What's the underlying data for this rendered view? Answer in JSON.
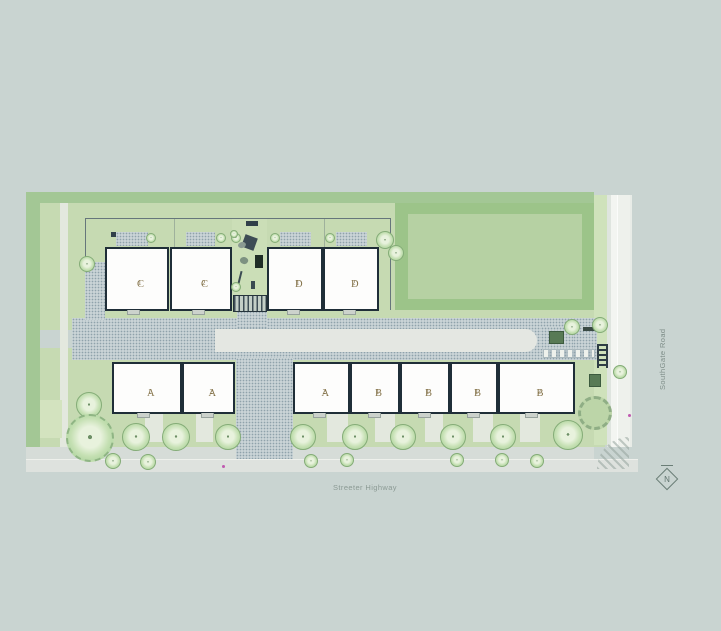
{
  "streets": {
    "right": "SouthGate Road",
    "bottom": "Streeter Highway"
  },
  "north_label": "N",
  "colors": {
    "background": "#c9d4d1",
    "planting_band": "#a3c795",
    "yard_green": "#c6dab2",
    "lawn": "#b6d1a3",
    "building_outline": "#1f2e38",
    "building_fill": "#fdfdfc",
    "unit_label": "#85744b",
    "road": "#eef1ed"
  },
  "site": {
    "buildings": [
      {
        "id": "C1",
        "letter": "C",
        "num": "1",
        "x": 105,
        "y": 247,
        "w": 64,
        "h": 64
      },
      {
        "id": "C2",
        "letter": "C",
        "num": "2",
        "x": 170,
        "y": 247,
        "w": 62,
        "h": 64
      },
      {
        "id": "D1",
        "letter": "D",
        "num": "1",
        "x": 267,
        "y": 247,
        "w": 56,
        "h": 64
      },
      {
        "id": "D2",
        "letter": "D",
        "num": "2",
        "x": 323,
        "y": 247,
        "w": 56,
        "h": 64
      },
      {
        "id": "A1",
        "letter": "A",
        "num": "1",
        "x": 112,
        "y": 362,
        "w": 70,
        "h": 52
      },
      {
        "id": "A2",
        "letter": "A",
        "num": "2",
        "x": 182,
        "y": 362,
        "w": 53,
        "h": 52
      },
      {
        "id": "A2b",
        "letter": "A",
        "num": "2",
        "x": 293,
        "y": 362,
        "w": 57,
        "h": 52
      },
      {
        "id": "B1a",
        "letter": "B",
        "num": "1",
        "x": 350,
        "y": 362,
        "w": 50,
        "h": 52
      },
      {
        "id": "B1b",
        "letter": "B",
        "num": "1",
        "x": 400,
        "y": 362,
        "w": 50,
        "h": 52
      },
      {
        "id": "B1c",
        "letter": "B",
        "num": "1",
        "x": 450,
        "y": 362,
        "w": 48,
        "h": 52
      },
      {
        "id": "B2",
        "letter": "B",
        "num": "2",
        "x": 498,
        "y": 362,
        "w": 77,
        "h": 52
      }
    ],
    "trees": [
      {
        "x": 151,
        "y": 238,
        "r": 5
      },
      {
        "x": 221,
        "y": 238,
        "r": 5
      },
      {
        "x": 236,
        "y": 238,
        "r": 5
      },
      {
        "x": 275,
        "y": 238,
        "r": 5
      },
      {
        "x": 330,
        "y": 238,
        "r": 5
      },
      {
        "x": 87,
        "y": 264,
        "r": 8
      },
      {
        "x": 234,
        "y": 234,
        "r": 4
      },
      {
        "x": 236,
        "y": 287,
        "r": 5
      },
      {
        "x": 385,
        "y": 240,
        "r": 9
      },
      {
        "x": 396,
        "y": 253,
        "r": 8
      },
      {
        "x": 572,
        "y": 327,
        "r": 8
      },
      {
        "x": 600,
        "y": 325,
        "r": 8
      },
      {
        "x": 620,
        "y": 372,
        "r": 7
      },
      {
        "x": 570,
        "y": 433,
        "r": 11
      },
      {
        "x": 89,
        "y": 405,
        "r": 13
      },
      {
        "x": 136,
        "y": 437,
        "r": 14
      },
      {
        "x": 176,
        "y": 437,
        "r": 14
      },
      {
        "x": 228,
        "y": 437,
        "r": 13
      },
      {
        "x": 303,
        "y": 437,
        "r": 13
      },
      {
        "x": 355,
        "y": 437,
        "r": 13
      },
      {
        "x": 403,
        "y": 437,
        "r": 13
      },
      {
        "x": 453,
        "y": 437,
        "r": 13
      },
      {
        "x": 503,
        "y": 437,
        "r": 13
      },
      {
        "x": 568,
        "y": 435,
        "r": 15
      },
      {
        "x": 113,
        "y": 461,
        "r": 8
      },
      {
        "x": 148,
        "y": 462,
        "r": 8
      },
      {
        "x": 311,
        "y": 461,
        "r": 7
      },
      {
        "x": 347,
        "y": 460,
        "r": 7
      },
      {
        "x": 457,
        "y": 460,
        "r": 7
      },
      {
        "x": 502,
        "y": 460,
        "r": 7
      },
      {
        "x": 537,
        "y": 461,
        "r": 7
      }
    ],
    "spiky_trees": [
      {
        "x": 90,
        "y": 438,
        "r": 24
      }
    ],
    "pads": [
      {
        "x": 116,
        "y": 232,
        "w": 32,
        "h": 14
      },
      {
        "x": 186,
        "y": 232,
        "w": 29,
        "h": 14
      },
      {
        "x": 280,
        "y": 232,
        "w": 31,
        "h": 14
      },
      {
        "x": 336,
        "y": 232,
        "w": 31,
        "h": 14
      }
    ],
    "stubs": [
      {
        "x": 145,
        "y": 414,
        "w": 18,
        "h": 28
      },
      {
        "x": 196,
        "y": 414,
        "w": 17,
        "h": 28
      },
      {
        "x": 327,
        "y": 414,
        "w": 21,
        "h": 28
      },
      {
        "x": 375,
        "y": 414,
        "w": 20,
        "h": 28
      },
      {
        "x": 425,
        "y": 414,
        "w": 18,
        "h": 28
      },
      {
        "x": 473,
        "y": 414,
        "w": 20,
        "h": 28
      },
      {
        "x": 520,
        "y": 414,
        "w": 20,
        "h": 28
      }
    ],
    "dots": [
      {
        "x": 222,
        "y": 465
      },
      {
        "x": 628,
        "y": 414
      }
    ]
  }
}
